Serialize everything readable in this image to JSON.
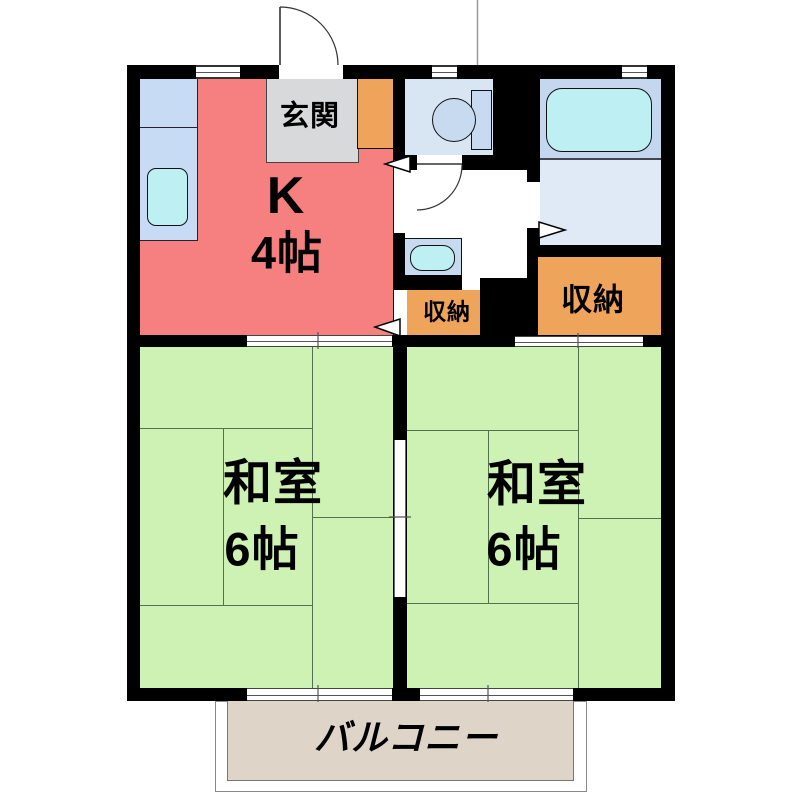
{
  "plan": {
    "entrance": {
      "label": "玄関"
    },
    "kitchen": {
      "label": "K",
      "size": "4帖"
    },
    "storage_small": {
      "label": "収納"
    },
    "storage_large": {
      "label": "収納"
    },
    "room_left": {
      "label": "和室",
      "size": "6帖"
    },
    "room_right": {
      "label": "和室",
      "size": "6帖"
    },
    "balcony": {
      "label": "バルコニー"
    }
  },
  "colors": {
    "wall": "#000000",
    "kitchen": "#F68080",
    "entrance_floor": "#D8D9DA",
    "cabinet": "#EFA45B",
    "storage": "#EFA45B",
    "room_green": "#CDF2B4",
    "tatami_line": "#55704d",
    "toilet_room": "#D8E5F3",
    "fixture_blue": "#C7DAF0",
    "bath_upper": "#C4D7EF",
    "bath_lower": "#DFEAF6",
    "water_cyan": "#BEEFF3",
    "counter_blue": "#C7DCF4",
    "balcony_floor": "#DED4C8"
  }
}
